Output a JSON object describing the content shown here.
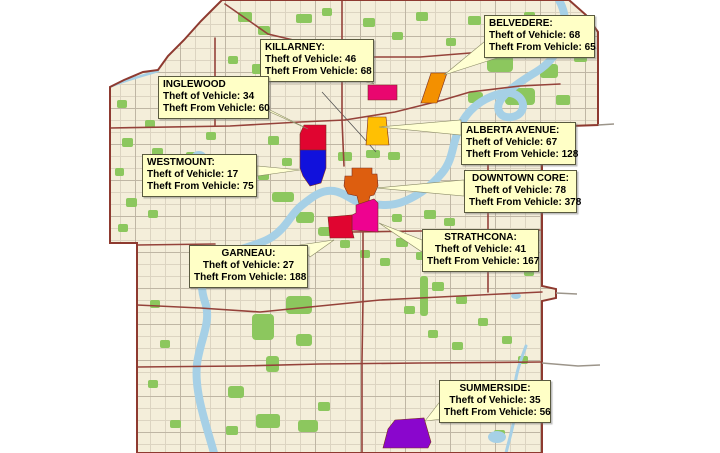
{
  "map": {
    "description": "Edmonton vehicle crime map",
    "colors": {
      "map_bg": "#F4EEDA",
      "outside_bg": "#FFFFFF",
      "boundary": "#8E3A30",
      "river": "#A6D0E6",
      "park": "#8CC75E",
      "road_minor": "#D6CDBB",
      "road_major": "#95423A",
      "label_bg": "#FFFFC6",
      "label_text": "#000000"
    }
  },
  "stat_fields": {
    "theft_of_label": "Theft of Vehicle:",
    "theft_from_label": "Theft From Vehicle:"
  },
  "neighborhoods": [
    {
      "id": "belvedere",
      "name": "BELVEDERE:",
      "theft_of_vehicle": 68,
      "theft_from_vehicle": 65,
      "label": {
        "x": 484,
        "y": 15,
        "w": 111,
        "align": "left"
      },
      "region": {
        "color": "#F39000",
        "points": "431,73 447,73 437,103 421,103"
      },
      "pointer": "444,75 484,42 500,57"
    },
    {
      "id": "killarney",
      "name": "KILLARNEY:",
      "theft_of_vehicle": 46,
      "theft_from_vehicle": 68,
      "label": {
        "x": 260,
        "y": 39,
        "w": 114,
        "align": "left"
      },
      "region": {
        "color": "#E9066F",
        "points": "368,85 397,85 397,100 368,100"
      },
      "pointer": "374,84 348,77 366,77"
    },
    {
      "id": "inglewood",
      "name": "INGLEWOOD",
      "theft_of_vehicle": 34,
      "theft_from_vehicle": 60,
      "label": {
        "x": 158,
        "y": 76,
        "w": 111,
        "align": "left"
      },
      "region": {
        "color": "#E00530",
        "points": "304,125 326,125 326,150 300,150 300,134"
      },
      "pointer": "308,129 260,105 270,112"
    },
    {
      "id": "alberta-avenue",
      "name": "ALBERTA AVENUE:",
      "theft_of_vehicle": 67,
      "theft_from_vehicle": 128,
      "label": {
        "x": 461,
        "y": 122,
        "w": 115,
        "align": "left"
      },
      "region": {
        "color": "#FFC003",
        "points": "368,117 386,117 389,145 366,145"
      },
      "pointer": "379,127 461,120 461,135"
    },
    {
      "id": "westmount",
      "name": "WESTMOUNT:",
      "theft_of_vehicle": 17,
      "theft_from_vehicle": 75,
      "label": {
        "x": 142,
        "y": 154,
        "w": 115,
        "align": "left"
      },
      "region": {
        "color": "#1111DC",
        "points": "300,150 326,150 326,168 321,183 310,186 303,176 300,168"
      },
      "pointer": "300,170 257,166 257,176"
    },
    {
      "id": "downtown-core",
      "name": "DOWNTOWN CORE:",
      "theft_of_vehicle": 78,
      "theft_from_vehicle": 378,
      "label": {
        "x": 464,
        "y": 170,
        "w": 113,
        "align": "center"
      },
      "region": {
        "color": "#DD5E0F",
        "points": "352,168 372,168 372,174 377,174 378,186 374,195 370,196 368,204 359,204 357,196 348,194 344,186 345,176 352,176"
      },
      "pointer": "376,188 464,180 464,196"
    },
    {
      "id": "strathcona",
      "name": "STRATHCONA:",
      "theft_of_vehicle": 41,
      "theft_from_vehicle": 167,
      "label": {
        "x": 422,
        "y": 229,
        "w": 117,
        "align": "center"
      },
      "region": {
        "color": "#EE0290",
        "points": "356,205 374,199 378,203 378,232 352,230 352,215 356,213"
      },
      "pointer": "379,223 422,240 422,252"
    },
    {
      "id": "garneau",
      "name": "GARNEAU:",
      "theft_of_vehicle": 27,
      "theft_from_vehicle": 188,
      "label": {
        "x": 189,
        "y": 245,
        "w": 119,
        "align": "center"
      },
      "region": {
        "color": "#E00530",
        "points": "328,217 352,215 352,230 354,238 330,238"
      },
      "pointer": "334,240 300,245 310,257"
    },
    {
      "id": "summerside",
      "name": "SUMMERSIDE:",
      "theft_of_vehicle": 35,
      "theft_from_vehicle": 56,
      "label": {
        "x": 439,
        "y": 380,
        "w": 112,
        "align": "center"
      },
      "region": {
        "color": "#8A06CD",
        "points": "395,420 424,418 431,442 428,448 383,448 388,429"
      },
      "pointer": "425,421 442,399 459,417"
    }
  ]
}
